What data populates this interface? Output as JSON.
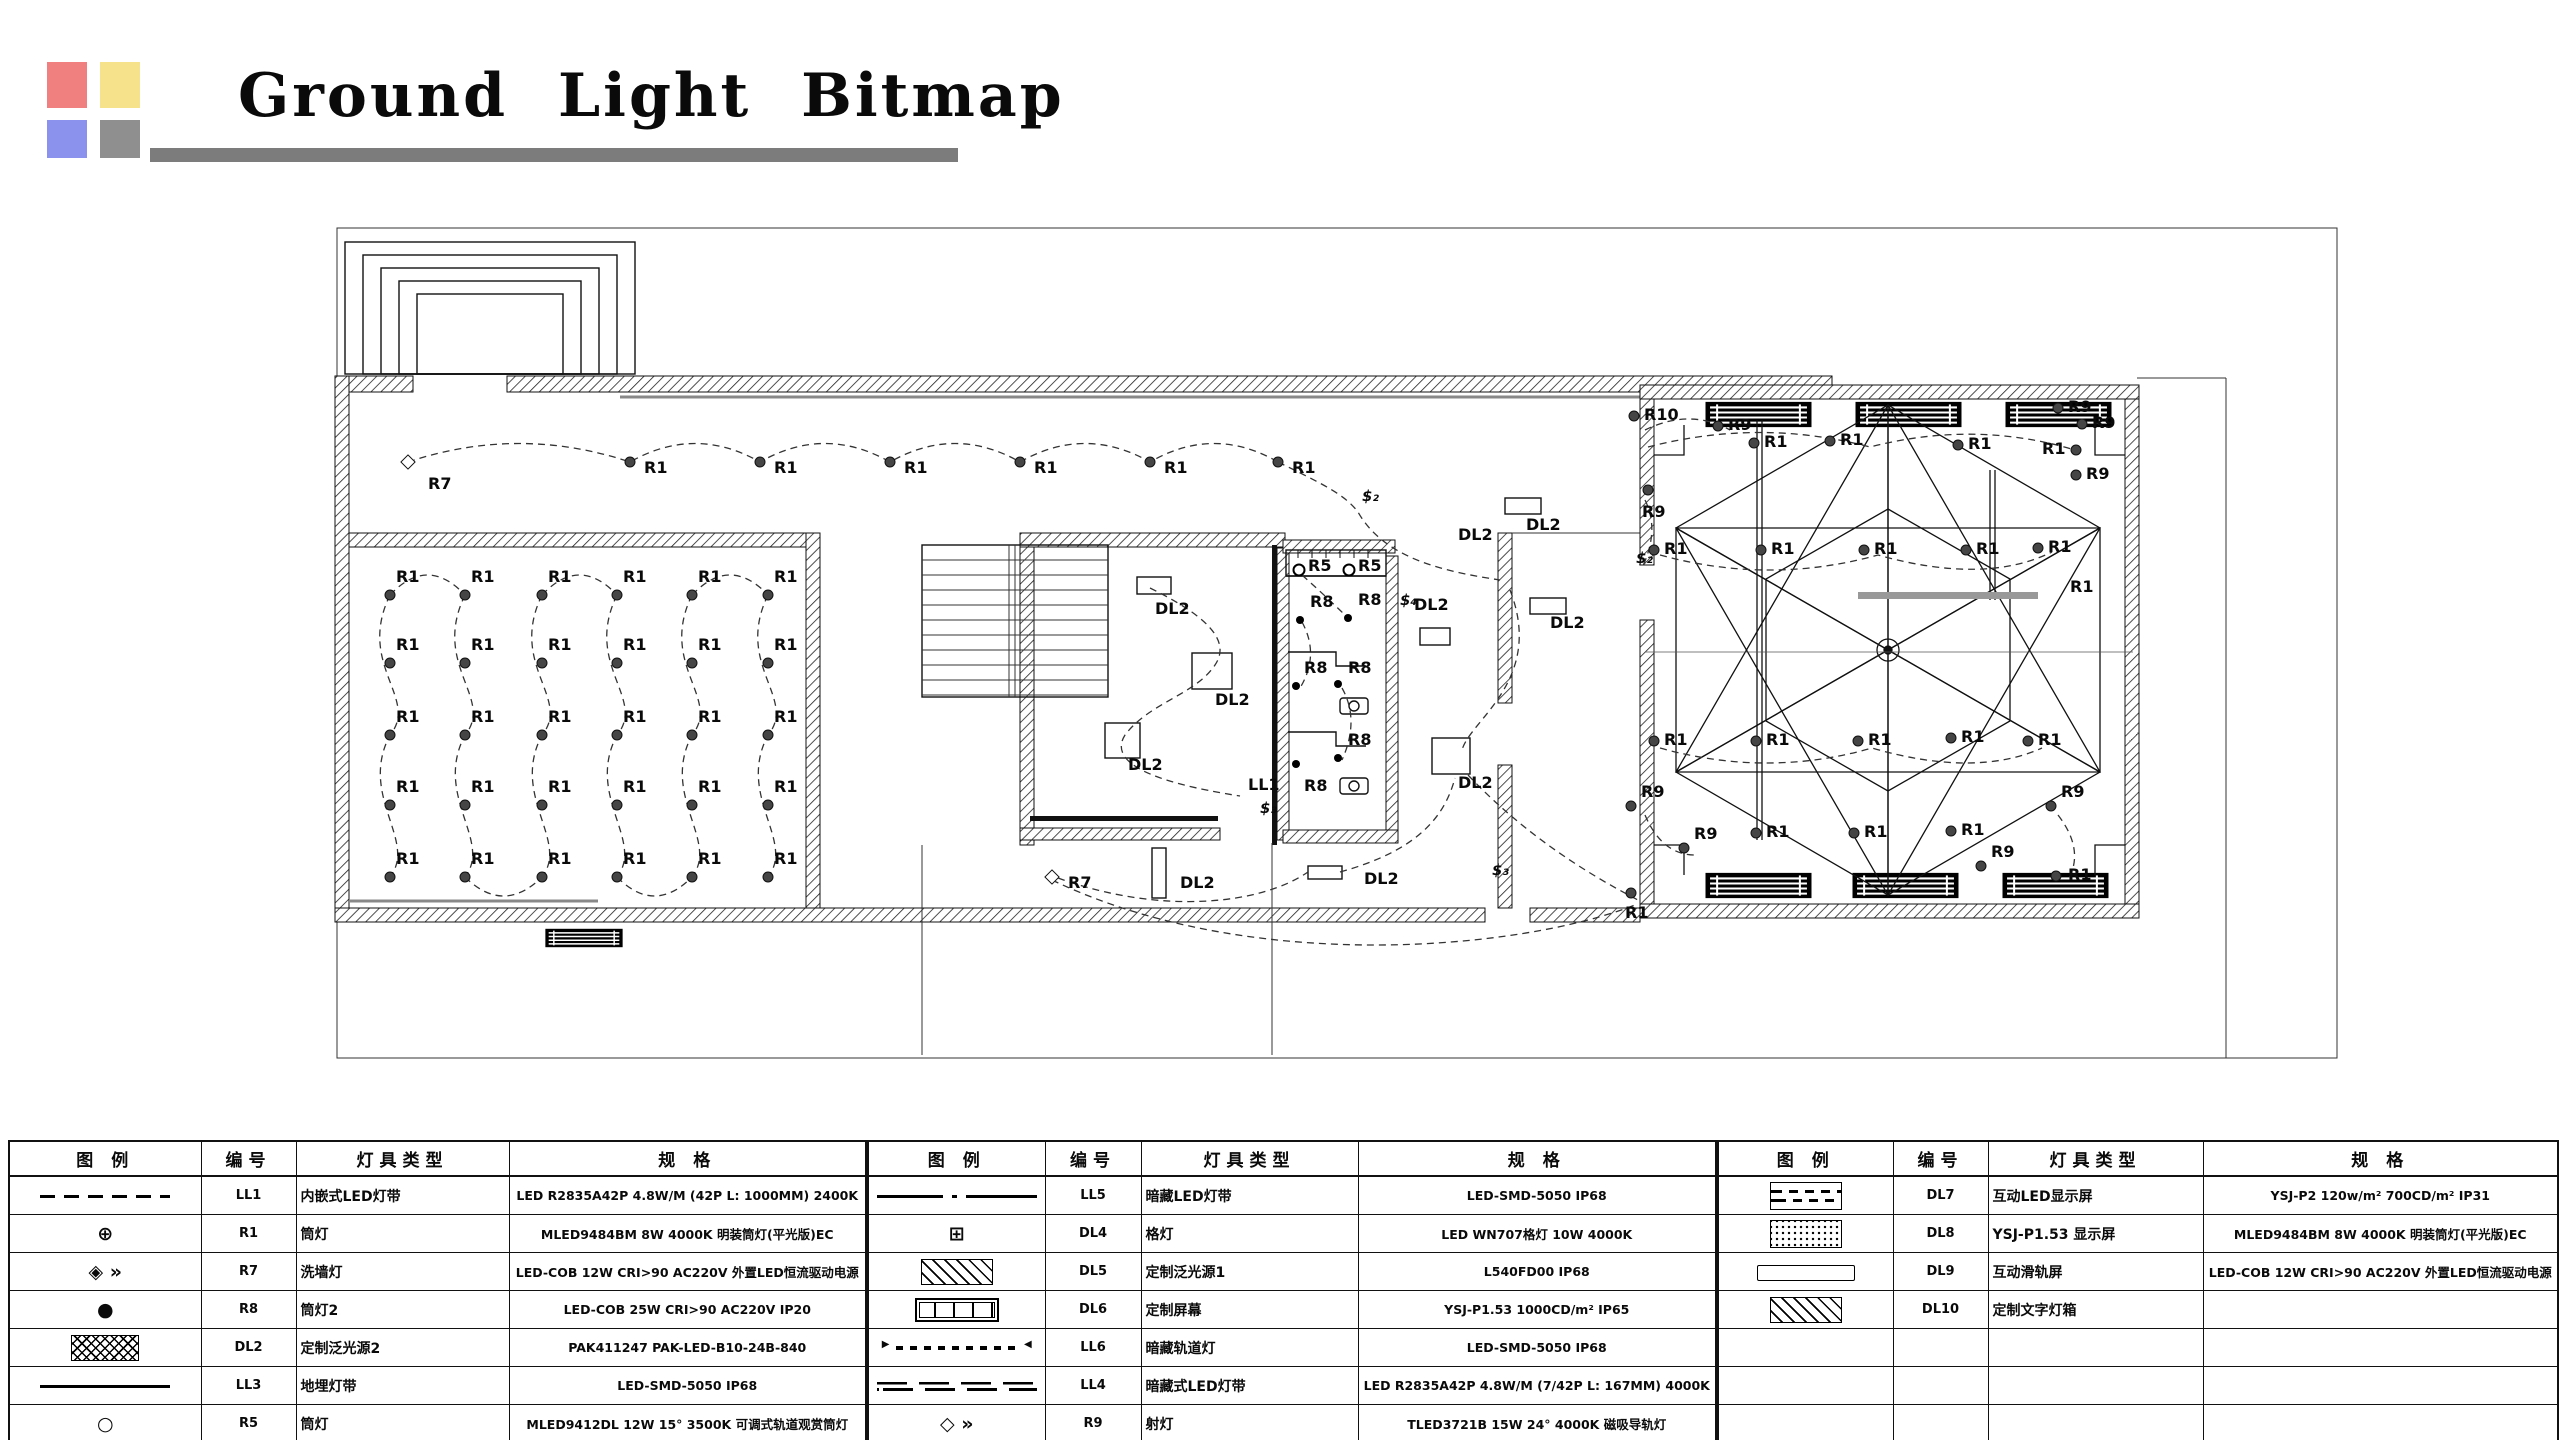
{
  "header": {
    "title": "Ground Light Bitmap",
    "squares": {
      "red": "#F08080",
      "yellow": "#F5E28A",
      "blue": "#8A92EE",
      "gray": "#8F8F8F"
    },
    "bar_color": "#7C7C7C"
  },
  "legend": {
    "columns": {
      "symbol": "图 例",
      "code": "编号",
      "type": "灯具类型",
      "spec": "规 格"
    },
    "sections": [
      {
        "rows": [
          {
            "sym": "lldash",
            "code": "LL1",
            "type": "内嵌式LED灯带",
            "spec": "LED R2835A42P 4.8W/M (42P L: 1000MM) 2400K"
          },
          {
            "sym": "target",
            "code": "R1",
            "type": "筒灯",
            "spec": "MLED9484BM 8W 4000K 明装筒灯(平光版)EC"
          },
          {
            "sym": "diamondarrow",
            "code": "R7",
            "type": "洗墙灯",
            "spec": "LED-COB 12W CRI>90 AC220V 外置LED恒流驱动电源"
          },
          {
            "sym": "fdot",
            "code": "R8",
            "type": "筒灯2",
            "spec": "LED-COB 25W CRI>90 AC220V IP20"
          },
          {
            "sym": "xhatch",
            "code": "DL2",
            "type": "定制泛光源2",
            "spec": "PAK411247 PAK-LED-B10-24B-840"
          },
          {
            "sym": "solid",
            "code": "LL3",
            "type": "地埋灯带",
            "spec": "LED-SMD-5050 IP68"
          },
          {
            "sym": "ocircle",
            "code": "R5",
            "type": "筒灯",
            "spec": "MLED9412DL 12W 15°  3500K 可调式轨道观赏筒灯"
          }
        ]
      },
      {
        "rows": [
          {
            "sym": "centerline",
            "code": "LL5",
            "type": "暗藏LED灯带",
            "spec": "LED-SMD-5050 IP68"
          },
          {
            "sym": "gridsq",
            "code": "DL4",
            "type": "格灯",
            "spec": "LED WN707格灯 10W 4000K"
          },
          {
            "sym": "hatch",
            "code": "DL5",
            "type": "定制泛光源1",
            "spec": "L540FD00 IP68"
          },
          {
            "sym": "segrect",
            "code": "DL6",
            "type": "定制屏幕",
            "spec": "YSJ-P1.53 1000CD/m² IP65"
          },
          {
            "sym": "arrowdash",
            "code": "LL6",
            "type": "暗藏轨道灯",
            "spec": "LED-SMD-5050 IP68"
          },
          {
            "sym": "dbldash",
            "code": "LL4",
            "type": "暗藏式LED灯带",
            "spec": "LED R2835A42P 4.8W/M (7/42P L: 167MM) 4000K"
          },
          {
            "sym": "diamondarrow2",
            "code": "R9",
            "type": "射灯",
            "spec": "TLED3721B 15W 24°  4000K 磁吸导轨灯"
          }
        ]
      },
      {
        "rows": [
          {
            "sym": "dashrect",
            "code": "DL7",
            "type": "互动LED显示屏",
            "spec": "YSJ-P2  120w/m² 700CD/m² IP31"
          },
          {
            "sym": "dotrect",
            "code": "DL8",
            "type": "YSJ-P1.53 显示屏",
            "spec": "MLED9484BM 8W 4000K 明装筒灯(平光版)EC"
          },
          {
            "sym": "plainrect",
            "code": "DL9",
            "type": "互动滑轨屏",
            "spec": "LED-COB 12W CRI>90 AC220V 外置LED恒流驱动电源"
          },
          {
            "sym": "hatch2",
            "code": "DL10",
            "type": "定制文字灯箱",
            "spec": ""
          },
          {
            "sym": "",
            "code": "",
            "type": "",
            "spec": ""
          },
          {
            "sym": "",
            "code": "",
            "type": "",
            "spec": ""
          },
          {
            "sym": "",
            "code": "",
            "type": "",
            "spec": ""
          }
        ]
      }
    ]
  },
  "plan": {
    "r1_grid": {
      "label": "R1",
      "cols": [
        390,
        465,
        542,
        617,
        692,
        768
      ],
      "rows": [
        595,
        663,
        735,
        805,
        877
      ]
    },
    "corridor": {
      "label": "R1",
      "xs": [
        630,
        760,
        890,
        1020,
        1150,
        1278
      ],
      "y": 462
    },
    "labels": [
      [
        "R7",
        408,
        462,
        "d",
        20,
        14
      ],
      [
        "$₂",
        1352,
        498,
        "-"
      ],
      [
        "DL2",
        1448,
        536,
        "-"
      ],
      [
        "DL2",
        1404,
        606,
        "-"
      ],
      [
        "DL2",
        1448,
        784,
        "-"
      ],
      [
        "DL2",
        1516,
        526,
        "-"
      ],
      [
        "DL2",
        1540,
        624,
        "-"
      ],
      [
        "DL2",
        1145,
        610,
        "-"
      ],
      [
        "DL2",
        1205,
        701,
        "-"
      ],
      [
        "DL2",
        1118,
        766,
        "-"
      ],
      [
        "LL1",
        1238,
        786,
        "-"
      ],
      [
        "$₃",
        1250,
        810,
        "-"
      ],
      [
        "R7",
        1052,
        877,
        "d",
        16,
        -2
      ],
      [
        "DL2",
        1170,
        884,
        "-"
      ],
      [
        "DL2",
        1354,
        880,
        "-"
      ],
      [
        "$₃",
        1482,
        872,
        "-"
      ],
      [
        "$₄",
        1390,
        602,
        "-"
      ],
      [
        "R5",
        1299,
        570,
        "o",
        9,
        -12
      ],
      [
        "R5",
        1349,
        570,
        "o",
        9,
        -12
      ],
      [
        "R8",
        1300,
        620,
        "f",
        10,
        -26
      ],
      [
        "R8",
        1348,
        618,
        "f",
        10,
        -26
      ],
      [
        "R8",
        1296,
        686,
        "f",
        8,
        -26
      ],
      [
        "R8",
        1338,
        684,
        "f",
        10,
        -24
      ],
      [
        "R8",
        1296,
        764,
        "f",
        8,
        14
      ],
      [
        "R8",
        1338,
        758,
        "f",
        10,
        -26
      ],
      [
        "R10",
        1634,
        416,
        "t"
      ],
      [
        "R9",
        1718,
        426,
        "t"
      ],
      [
        "R9",
        2058,
        408,
        "t"
      ],
      [
        "R9",
        2082,
        424,
        "t"
      ],
      [
        "R9",
        1648,
        490,
        "t",
        -6,
        14
      ],
      [
        "R1",
        1754,
        443,
        "t"
      ],
      [
        "R1",
        1830,
        441,
        "t"
      ],
      [
        "R1",
        1958,
        445,
        "t"
      ],
      [
        "R1",
        2076,
        450,
        "t",
        -34,
        -9
      ],
      [
        "R9",
        2076,
        475,
        "t"
      ],
      [
        "R1",
        1654,
        550,
        "t"
      ],
      [
        "R1",
        1761,
        550,
        "t"
      ],
      [
        "R1",
        1864,
        550,
        "t"
      ],
      [
        "R1",
        1966,
        550,
        "t"
      ],
      [
        "R1",
        2038,
        548,
        "t"
      ],
      [
        "R1",
        2060,
        588,
        "-"
      ],
      [
        "R1",
        1654,
        741,
        "t"
      ],
      [
        "R1",
        1756,
        741,
        "t"
      ],
      [
        "R1",
        1858,
        741,
        "t"
      ],
      [
        "R1",
        1951,
        738,
        "t"
      ],
      [
        "R1",
        2028,
        741,
        "t"
      ],
      [
        "R1",
        1756,
        833,
        "t"
      ],
      [
        "R1",
        1854,
        833,
        "t"
      ],
      [
        "R1",
        1951,
        831,
        "t"
      ],
      [
        "R9",
        1631,
        806,
        "t",
        10,
        -22
      ],
      [
        "R9",
        1684,
        848,
        "t",
        10,
        -22
      ],
      [
        "R9",
        1981,
        866,
        "t",
        10,
        -22
      ],
      [
        "R9",
        2051,
        806,
        "t",
        10,
        -22
      ],
      [
        "R1",
        1631,
        893,
        "t",
        -6,
        12
      ],
      [
        "R1",
        2056,
        876,
        "t",
        12,
        -9
      ],
      [
        "$₂",
        1626,
        560,
        "-"
      ]
    ]
  }
}
